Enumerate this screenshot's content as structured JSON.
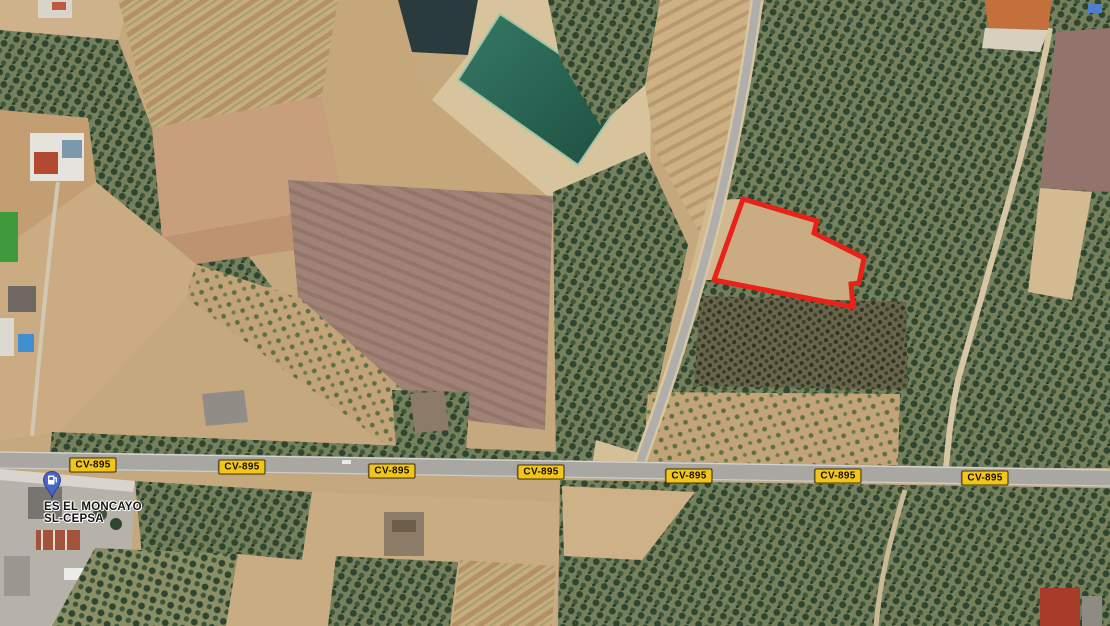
{
  "map": {
    "imagery": "aerial-farmland-satellite-view",
    "road_label": "CV-895",
    "station": {
      "name_line1": "ES EL MONCAYO",
      "name_line2": "SL-CEPSA",
      "pin_icon": "fuel-pump-icon",
      "pin_color": "#4b66c8",
      "pin_border": "#2c4394"
    },
    "parcel_outline": {
      "points": "743,199 817,221 814,233 864,258 859,283 851,284 853,307 714,280",
      "color": "#e82119",
      "width": "5"
    },
    "colors": {
      "badge_bg": "#f2c51d",
      "badge_border": "#4a3a00",
      "badge_text": "#161200",
      "water": "#2b6e58",
      "road": "#a8a7a2"
    }
  }
}
